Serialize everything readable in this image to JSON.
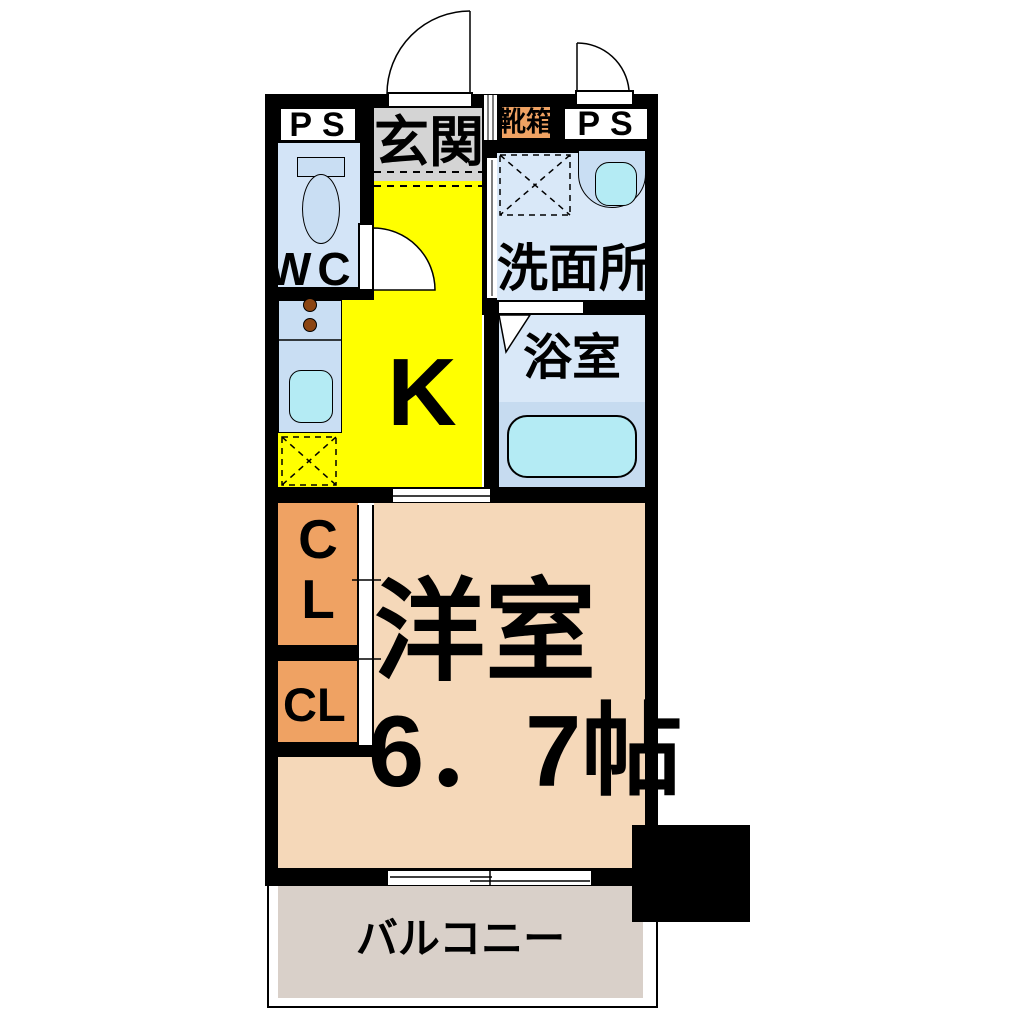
{
  "floorplan": {
    "type": "japanese-apartment-1K-floor-plan",
    "labels": {
      "ps_left": "PS",
      "ps_right": "PS",
      "genkan": "玄関",
      "kutsubako": "靴箱",
      "wc": "WC",
      "senmenjo": "洗面所",
      "yokushitsu": "浴室",
      "k": "K",
      "cl_upper_c": "C",
      "cl_upper_l": "L",
      "cl_lower": "CL",
      "room": "洋室",
      "room_size": "6．7帖",
      "balcony": "バルコニー"
    },
    "colors": {
      "wall": "#000000",
      "entrance_floor_gray": "#d4d4d4",
      "kitchen_yellow": "#ffff00",
      "wet_area_blue": "#d9e8f8",
      "wc_blue": "#d3e4f7",
      "bath_lower_blue": "#c6dbf0",
      "fixture_blue": "#c9def3",
      "fixture_cyan": "#b4ebf4",
      "closet_orange": "#efa263",
      "room_peach": "#f5d8b9",
      "balcony_gray": "#d9d0c9",
      "burner_brown": "#8b4513"
    },
    "fixtures": [
      "entrance-door-swing",
      "sub-door-swing",
      "wc-door-swing",
      "toilet",
      "kitchen-counter",
      "stove-burners",
      "kitchen-sink",
      "refrigerator-space",
      "washing-machine-space",
      "washbasin",
      "bathtub",
      "bath-folding-door",
      "closet-sliding-door",
      "balcony-sliding-window",
      "structural-pillar"
    ]
  }
}
